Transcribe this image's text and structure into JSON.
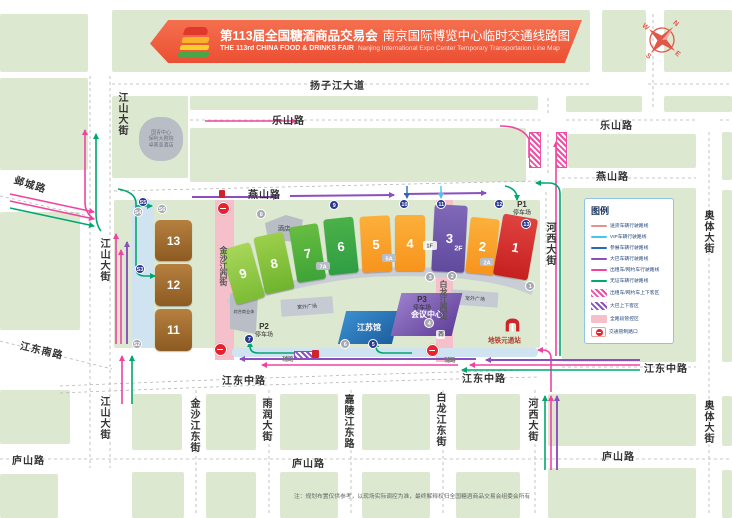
{
  "banner": {
    "title_cn": "第113届全国糖酒商品交易会",
    "subtitle_cn": "南京国际博览中心临时交通线路图",
    "title_en": "THE 113rd CHINA FOOD & DRINKS FAIR",
    "subtitle_en": "Nanjing International Expo Center Temporary Transportation Line Map"
  },
  "compass": {
    "n": "N",
    "e": "E",
    "s": "S",
    "w": "W"
  },
  "legend": {
    "title": "图例",
    "routes": [
      {
        "label": "送货车辆行驶路线",
        "color": "#e8918c"
      },
      {
        "label": "VIP车辆行驶路线",
        "color": "#45c6f2"
      },
      {
        "label": "参展车辆行驶路线",
        "color": "#2a6bb5"
      },
      {
        "label": "大巴车辆行驶路线",
        "color": "#8c4fc0"
      },
      {
        "label": "出租车/网约车行驶路线",
        "color": "#f043a0"
      },
      {
        "label": "无证车辆行驶路线",
        "color": "#00a76f"
      }
    ],
    "zones": [
      {
        "label": "出租车/网约车上下客区",
        "color": "#f04da5",
        "type": "hatch"
      },
      {
        "label": "大巴上下客区",
        "color": "#8c4fc0",
        "type": "hatch"
      },
      {
        "label": "全路段管控区",
        "color": "#f6c0cb",
        "type": "solid"
      }
    ],
    "control_label": "交通管制路口"
  },
  "roads": {
    "yangzijiang": "扬子江大道",
    "leshan": "乐山路",
    "yanshan": "燕山路",
    "yecheng": "邺城路",
    "jiangshan": "江山大街",
    "jiangdong_south": "江东南路",
    "jiangdong_middle": "江东中路",
    "lushan": "庐山路",
    "jinshajiang_west": "金沙江西街",
    "bailongjiang_west": "白龙江西街",
    "hexi": "河西大街",
    "aoti": "奥体大街",
    "jinshajiang_east": "金沙江东街",
    "yurun": "雨润大街",
    "jialingjiang_east": "嘉陵江东路",
    "bailongjiang_east": "白龙江东街",
    "west_badge": "西",
    "service_road": "辅路"
  },
  "buildings": {
    "hotel": "酒店",
    "guoqing_line1": "国青中心",
    "guoqing_line2": "保利大剧院",
    "guoqing_line3": "卓美亚酒店",
    "commercial": "综合商业体",
    "plaza": "室外广场",
    "jiangsu_hall": "江苏馆",
    "conference_center": "会议中心",
    "metro_station": "地铁元通站"
  },
  "parking": {
    "p1": "P1",
    "p2": "P2",
    "p3": "P3",
    "lot": "停车场"
  },
  "annex": {
    "a7": "7A",
    "a5": "5A",
    "a2": "2A",
    "f1": "1F"
  },
  "halls": [
    {
      "label": "9",
      "x": 228,
      "y": 245,
      "w": 30,
      "h": 57,
      "rot": -16,
      "c1": "#a8d65a",
      "c2": "#7cbc35"
    },
    {
      "label": "8",
      "x": 259,
      "y": 234,
      "w": 30,
      "h": 58,
      "rot": -12,
      "c1": "#9ccf4b",
      "c2": "#6fb42e"
    },
    {
      "label": "7",
      "x": 293,
      "y": 225,
      "w": 29,
      "h": 56,
      "rot": -9,
      "c1": "#67bd41",
      "c2": "#3da437"
    },
    {
      "label": "6",
      "x": 326,
      "y": 218,
      "w": 30,
      "h": 56,
      "rot": -6,
      "c1": "#4bb148",
      "c2": "#2f9e44"
    },
    {
      "label": "5",
      "x": 361,
      "y": 216,
      "w": 30,
      "h": 56,
      "rot": -3,
      "c1": "#fbb03b",
      "c2": "#f7941d"
    },
    {
      "label": "4",
      "x": 395,
      "y": 215,
      "w": 30,
      "h": 56,
      "rot": 0,
      "c1": "#fbb03b",
      "c2": "#f7941d"
    },
    {
      "label": "3",
      "sub": "2F",
      "x": 433,
      "y": 205,
      "w": 33,
      "h": 67,
      "rot": 3,
      "c1": "#8168b8",
      "c2": "#5f4a9e"
    },
    {
      "label": "2",
      "x": 468,
      "y": 218,
      "w": 29,
      "h": 56,
      "rot": 6,
      "c1": "#fbb03b",
      "c2": "#f7941d"
    },
    {
      "label": "1",
      "x": 498,
      "y": 216,
      "w": 35,
      "h": 62,
      "rot": 10,
      "c1": "#e04340",
      "c2": "#c5201f"
    }
  ],
  "brown_halls": [
    {
      "label": "13",
      "x": 155,
      "y": 220,
      "w": 37,
      "h": 41
    },
    {
      "label": "12",
      "x": 155,
      "y": 264,
      "w": 37,
      "h": 42
    },
    {
      "label": "11",
      "x": 155,
      "y": 309,
      "w": 37,
      "h": 42
    }
  ],
  "gates": [
    {
      "label": "1",
      "x": 530,
      "y": 286,
      "open": false
    },
    {
      "label": "2",
      "x": 452,
      "y": 276,
      "open": false
    },
    {
      "label": "3",
      "x": 430,
      "y": 277,
      "open": false
    },
    {
      "label": "4",
      "x": 429,
      "y": 323,
      "open": false
    },
    {
      "label": "5",
      "x": 373,
      "y": 344,
      "open": true
    },
    {
      "label": "6",
      "x": 345,
      "y": 344,
      "open": false
    },
    {
      "label": "7",
      "x": 249,
      "y": 339,
      "open": true
    },
    {
      "label": "8",
      "x": 261,
      "y": 214,
      "open": false
    },
    {
      "label": "9",
      "x": 334,
      "y": 205,
      "open": true
    },
    {
      "label": "10",
      "x": 404,
      "y": 204,
      "open": true
    },
    {
      "label": "11",
      "x": 441,
      "y": 204,
      "open": true
    },
    {
      "label": "12",
      "x": 499,
      "y": 204,
      "open": true
    },
    {
      "label": "13",
      "x": 526,
      "y": 224,
      "open": true
    },
    {
      "label": "S2",
      "x": 137,
      "y": 344,
      "open": false
    },
    {
      "label": "S3",
      "x": 140,
      "y": 269,
      "open": true
    },
    {
      "label": "S4",
      "x": 138,
      "y": 212,
      "open": false
    },
    {
      "label": "S5",
      "x": 143,
      "y": 202,
      "open": true
    },
    {
      "label": "S6",
      "x": 162,
      "y": 209,
      "open": false
    }
  ],
  "note": "注：规划布置仅供参考，以现场实际调控为准，最终解释权归全国糖酒商品交易会组委会所有"
}
